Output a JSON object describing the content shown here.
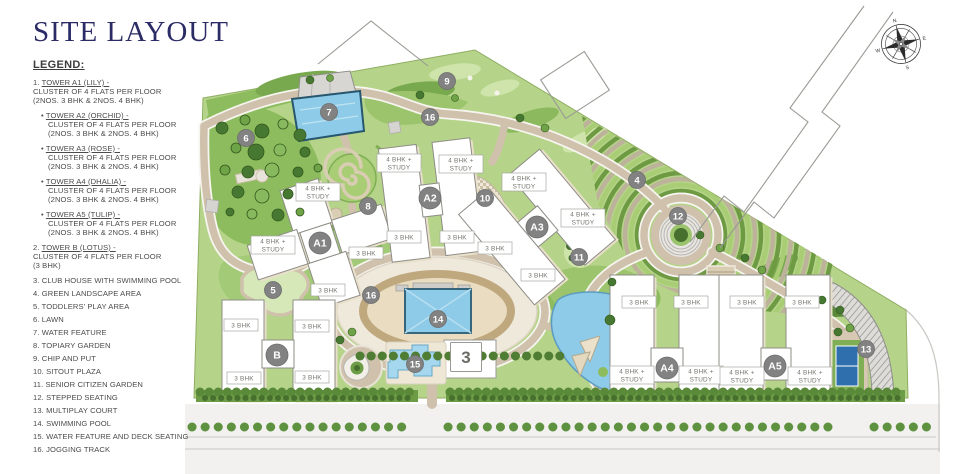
{
  "title": "SITE LAYOUT",
  "legend": {
    "heading": "LEGEND:",
    "items": [
      {
        "prefix": "1.",
        "head": "TOWER A1 (LILY) -",
        "lines": [
          "CLUSTER OF 4 FLATS PER FLOOR",
          "(2NOS. 3 BHK & 2NOS. 4 BHK)"
        ],
        "bullet": false
      },
      {
        "prefix": "•",
        "head": "TOWER A2 (ORCHID) -",
        "lines": [
          "CLUSTER OF 4 FLATS PER FLOOR",
          "(2NOS. 3 BHK & 2NOS. 4 BHK)"
        ],
        "bullet": true
      },
      {
        "prefix": "•",
        "head": "TOWER A3 (ROSE) -",
        "lines": [
          "CLUSTER OF 4 FLATS PER FLOOR",
          "(2NOS. 3 BHK & 2NOS. 4 BHK)"
        ],
        "bullet": true
      },
      {
        "prefix": "•",
        "head": "TOWER A4 (DHALIA) -",
        "lines": [
          "CLUSTER OF 4 FLATS PER FLOOR",
          "(2NOS. 3 BHK & 2NOS. 4 BHK)"
        ],
        "bullet": true
      },
      {
        "prefix": "•",
        "head": "TOWER A5 (TULIP) -",
        "lines": [
          "CLUSTER OF 4 FLATS PER FLOOR",
          "(2NOS. 3 BHK & 2NOS. 4 BHK)"
        ],
        "bullet": true
      },
      {
        "prefix": "2.",
        "head": "TOWER B (LOTUS) -",
        "lines": [
          "CLUSTER OF 4 FLATS PER FLOOR",
          "(3 BHK)"
        ],
        "bullet": false
      },
      {
        "prefix": "3.",
        "head": "",
        "text": "CLUB HOUSE WITH SWIMMING POOL",
        "lines": [],
        "bullet": false
      },
      {
        "prefix": "4.",
        "head": "",
        "text": "GREEN LANDSCAPE AREA",
        "lines": [],
        "bullet": false
      },
      {
        "prefix": "5.",
        "head": "",
        "text": "TODDLERS' PLAY AREA",
        "lines": [],
        "bullet": false
      },
      {
        "prefix": "6.",
        "head": "",
        "text": "LAWN",
        "lines": [],
        "bullet": false
      },
      {
        "prefix": "7.",
        "head": "",
        "text": "WATER FEATURE",
        "lines": [],
        "bullet": false
      },
      {
        "prefix": "8.",
        "head": "",
        "text": "TOPIARY GARDEN",
        "lines": [],
        "bullet": false
      },
      {
        "prefix": "9.",
        "head": "",
        "text": "CHIP AND PUT",
        "lines": [],
        "bullet": false
      },
      {
        "prefix": "10.",
        "head": "",
        "text": "SITOUT PLAZA",
        "lines": [],
        "bullet": false
      },
      {
        "prefix": "11.",
        "head": "",
        "text": "SENIOR CITIZEN GARDEN",
        "lines": [],
        "bullet": false
      },
      {
        "prefix": "12.",
        "head": "",
        "text": "STEPPED SEATING",
        "lines": [],
        "bullet": false
      },
      {
        "prefix": "13.",
        "head": "",
        "text": "MULTIPLAY COURT",
        "lines": [],
        "bullet": false
      },
      {
        "prefix": "14.",
        "head": "",
        "text": "SWIMMING POOL",
        "lines": [],
        "bullet": false
      },
      {
        "prefix": "15.",
        "head": "",
        "text": "WATER FEATURE AND DECK SEATING",
        "lines": [],
        "bullet": false
      },
      {
        "prefix": "16.",
        "head": "",
        "text": "JOGGING TRACK",
        "lines": [],
        "bullet": false
      }
    ]
  },
  "map": {
    "compass": {
      "icon": "compass-rose-icon",
      "points": [
        "N",
        "E",
        "S",
        "W"
      ]
    },
    "colors": {
      "site_green": "#b5d489",
      "dark_green": "#47702e",
      "path_tan": "#cfc1ac",
      "water_blue": "#8ecbe8",
      "building_white": "#ffffff",
      "marker_grey": "#828282",
      "court_blue": "#2f6fae",
      "title_navy": "#2b2b66"
    },
    "markers": [
      {
        "label": "6",
        "x": 246,
        "y": 138,
        "kind": "num"
      },
      {
        "label": "7",
        "x": 329,
        "y": 112,
        "kind": "num"
      },
      {
        "label": "9",
        "x": 447,
        "y": 81,
        "kind": "num"
      },
      {
        "label": "16",
        "x": 430,
        "y": 117,
        "kind": "num"
      },
      {
        "label": "8",
        "x": 368,
        "y": 206,
        "kind": "num"
      },
      {
        "label": "10",
        "x": 485,
        "y": 198,
        "kind": "num"
      },
      {
        "label": "4",
        "x": 637,
        "y": 180,
        "kind": "num"
      },
      {
        "label": "12",
        "x": 678,
        "y": 216,
        "kind": "num"
      },
      {
        "label": "11",
        "x": 579,
        "y": 257,
        "kind": "num"
      },
      {
        "label": "5",
        "x": 273,
        "y": 290,
        "kind": "num"
      },
      {
        "label": "16",
        "x": 371,
        "y": 295,
        "kind": "num"
      },
      {
        "label": "14",
        "x": 438,
        "y": 319,
        "kind": "num"
      },
      {
        "label": "15",
        "x": 415,
        "y": 364,
        "kind": "num"
      },
      {
        "label": "13",
        "x": 866,
        "y": 349,
        "kind": "num"
      },
      {
        "label": "3",
        "x": 466,
        "y": 357,
        "kind": "box"
      },
      {
        "label": "A1",
        "x": 320,
        "y": 243,
        "kind": "tower"
      },
      {
        "label": "A2",
        "x": 430,
        "y": 198,
        "kind": "tower"
      },
      {
        "label": "A3",
        "x": 537,
        "y": 227,
        "kind": "tower"
      },
      {
        "label": "A4",
        "x": 667,
        "y": 368,
        "kind": "tower"
      },
      {
        "label": "A5",
        "x": 775,
        "y": 366,
        "kind": "tower"
      },
      {
        "label": "B",
        "x": 277,
        "y": 355,
        "kind": "tower"
      }
    ],
    "unit_labels": [
      {
        "lines": [
          "4 BHK +",
          "STUDY"
        ],
        "x": 318,
        "y": 192
      },
      {
        "lines": [
          "4 BHK +",
          "STUDY"
        ],
        "x": 273,
        "y": 245
      },
      {
        "lines": [
          "4 BHK +",
          "STUDY"
        ],
        "x": 399,
        "y": 163
      },
      {
        "lines": [
          "4 BHK +",
          "STUDY"
        ],
        "x": 461,
        "y": 164
      },
      {
        "lines": [
          "4 BHK +",
          "STUDY"
        ],
        "x": 524,
        "y": 182
      },
      {
        "lines": [
          "4 BHK +",
          "STUDY"
        ],
        "x": 583,
        "y": 218
      },
      {
        "lines": [
          "4 BHK +",
          "STUDY"
        ],
        "x": 632,
        "y": 375
      },
      {
        "lines": [
          "4 BHK +",
          "STUDY"
        ],
        "x": 701,
        "y": 375
      },
      {
        "lines": [
          "4 BHK +",
          "STUDY"
        ],
        "x": 742,
        "y": 376
      },
      {
        "lines": [
          "4 BHK +",
          "STUDY"
        ],
        "x": 810,
        "y": 376
      },
      {
        "lines": [
          "3 BHK"
        ],
        "x": 366,
        "y": 253
      },
      {
        "lines": [
          "3 BHK"
        ],
        "x": 328,
        "y": 290
      },
      {
        "lines": [
          "3 BHK"
        ],
        "x": 404,
        "y": 237
      },
      {
        "lines": [
          "3 BHK"
        ],
        "x": 457,
        "y": 237
      },
      {
        "lines": [
          "3 BHK"
        ],
        "x": 495,
        "y": 248
      },
      {
        "lines": [
          "3 BHK"
        ],
        "x": 538,
        "y": 275
      },
      {
        "lines": [
          "3 BHK"
        ],
        "x": 241,
        "y": 325
      },
      {
        "lines": [
          "3 BHK"
        ],
        "x": 312,
        "y": 326
      },
      {
        "lines": [
          "3 BHK"
        ],
        "x": 244,
        "y": 378
      },
      {
        "lines": [
          "3 BHK"
        ],
        "x": 312,
        "y": 377
      },
      {
        "lines": [
          "3 BHK"
        ],
        "x": 639,
        "y": 302
      },
      {
        "lines": [
          "3 BHK"
        ],
        "x": 691,
        "y": 302
      },
      {
        "lines": [
          "3 BHK"
        ],
        "x": 747,
        "y": 302
      },
      {
        "lines": [
          "3 BHK"
        ],
        "x": 802,
        "y": 302
      }
    ]
  }
}
